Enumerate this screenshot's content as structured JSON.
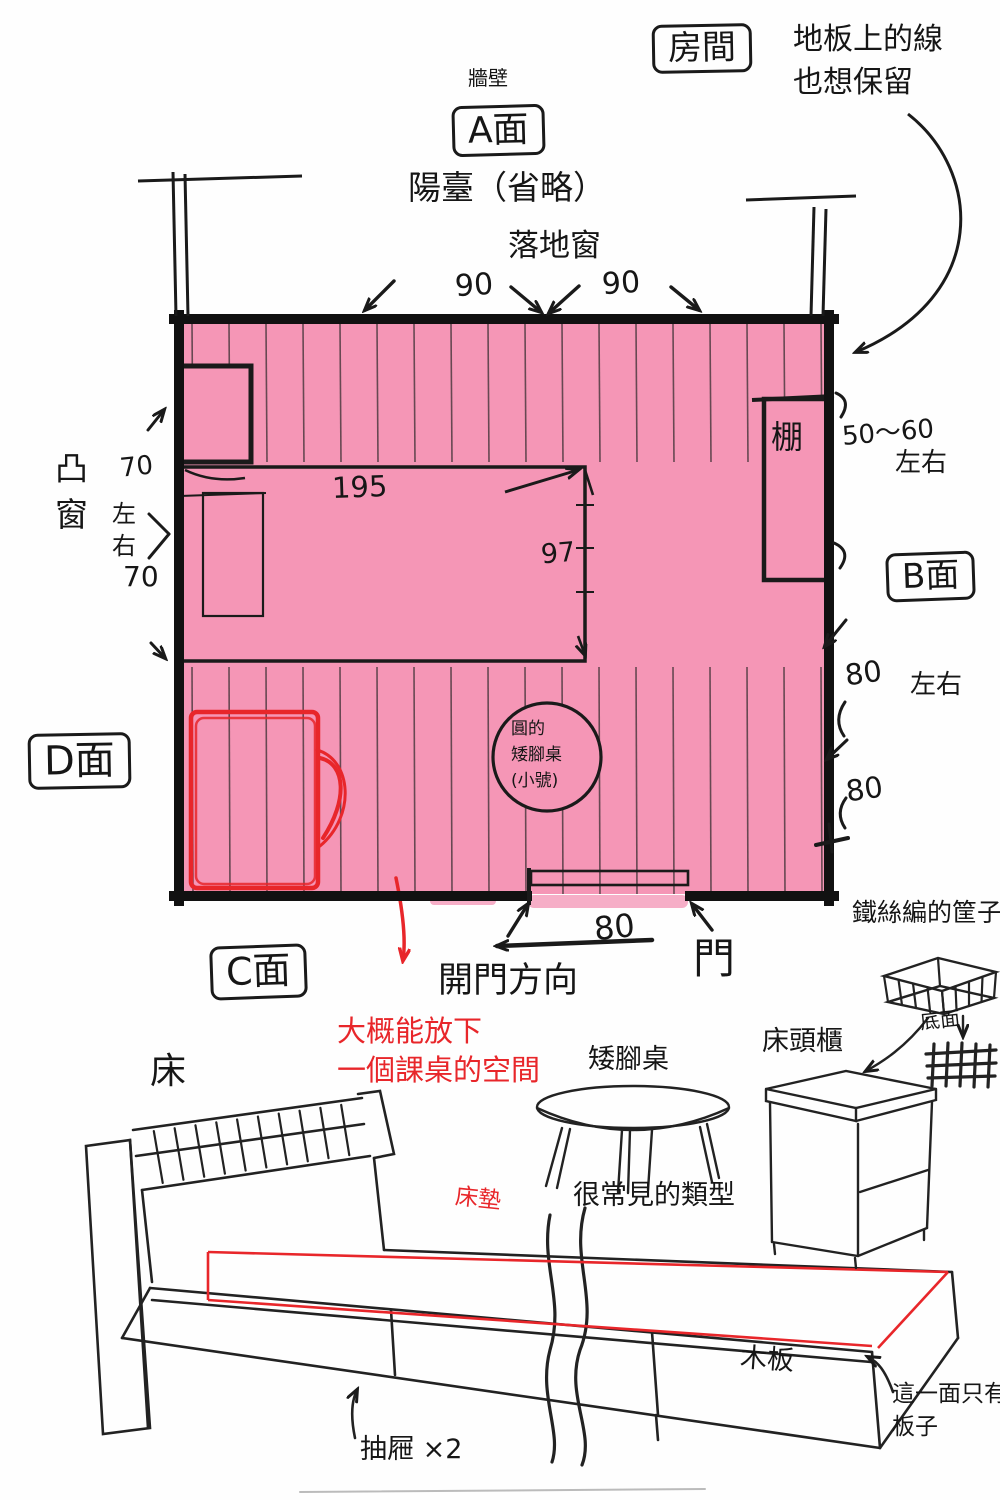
{
  "plan": {
    "room_box": "房間",
    "floor_note_1": "地板上的線",
    "floor_note_2": "也想保留",
    "wall": "牆壁",
    "side_a": "A面",
    "side_b": "B面",
    "side_c": "C面",
    "side_d": "D面",
    "balcony": "陽臺（省略）",
    "french_window": "落地窗",
    "win_dim_1": "90",
    "win_dim_2": "90",
    "bay_window": "凸窗",
    "bay_dim_1": "70",
    "bay_lr": "左右",
    "bay_dim_2": "70",
    "bed_width": "195",
    "bed_depth": "97",
    "shelf": "棚",
    "shelf_dim": "50～60",
    "shelf_lr": "左右",
    "b_dim_1": "80",
    "b_lr": "左右",
    "b_dim_2": "80",
    "round_table_1": "圓的",
    "round_table_2": "矮腳桌",
    "round_table_3": "(小號)",
    "door": "門",
    "door_dim": "80",
    "door_dir": "開門方向",
    "desk_note_1": "大概能放下",
    "desk_note_2": "一個課桌的空間"
  },
  "furniture": {
    "bed": "床",
    "mattress": "床墊",
    "drawers": "抽屜 ×2",
    "board": "木板",
    "board_note_1": "這一面只有",
    "board_note_2": "板子",
    "low_table": "矮腳桌",
    "table_note": "很常見的類型",
    "nightstand": "床頭櫃",
    "basket": "鐵絲編的筐子",
    "basket_bottom": "底面"
  },
  "colors": {
    "floor_pink": "#f596b6",
    "pink_spill": "#f6aec7",
    "accent_red": "#e8262a",
    "ink": "#1a1a1a"
  }
}
